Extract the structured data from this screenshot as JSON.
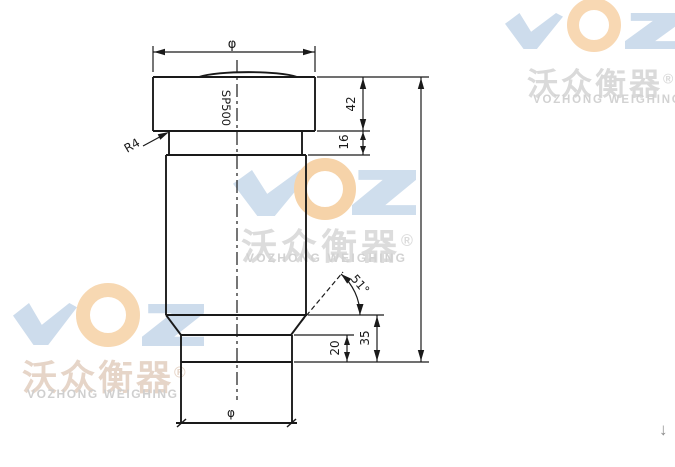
{
  "watermarks": {
    "brand": "VOZ",
    "cn": "沃众衡器",
    "reg": "®",
    "en": "VOZHONG WEIGHING",
    "colors": {
      "logo_blue": "#cddcec",
      "logo_orange": "#f6d4ab",
      "cn_gray": "#dadada",
      "cn_warm": "#e6d5c8",
      "en_gray": "#d2d2d2"
    }
  },
  "drawing": {
    "model": "SP500",
    "line_color": "#1a1a1a",
    "labels": {
      "top_diameter": "φ",
      "bottom_diameter": "φ",
      "cap_height": "42",
      "collar_height": "16",
      "cone_angle": "51°",
      "base_step_height": "20",
      "base_total_height": "35",
      "fillet_radius": "R4"
    }
  },
  "page": {
    "scroll_down_arrow": "↓"
  }
}
